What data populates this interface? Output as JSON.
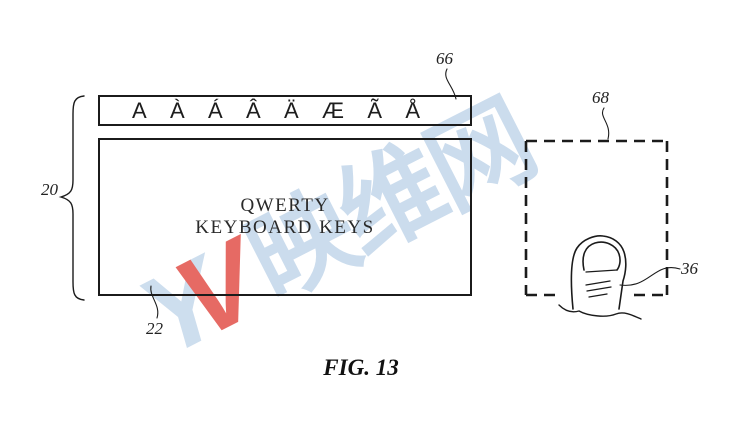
{
  "figure": {
    "caption": "FIG. 13"
  },
  "accent_bar": {
    "keys": [
      "A",
      "À",
      "Á",
      "Â",
      "Ä",
      "Æ",
      "Ã",
      "Å"
    ]
  },
  "keyboard_box": {
    "line1": "QWERTY",
    "line2": "KEYBOARD KEYS"
  },
  "labels": {
    "keyboard_group": "20",
    "keyboard_keys": "22",
    "finger": "36",
    "accent_bar": "66",
    "touch_region": "68"
  },
  "watermark": {
    "logo_y": "Y",
    "logo_v": "V",
    "text": "映维网",
    "blue_color": "#c2d6ea",
    "red_color": "#e25048"
  }
}
